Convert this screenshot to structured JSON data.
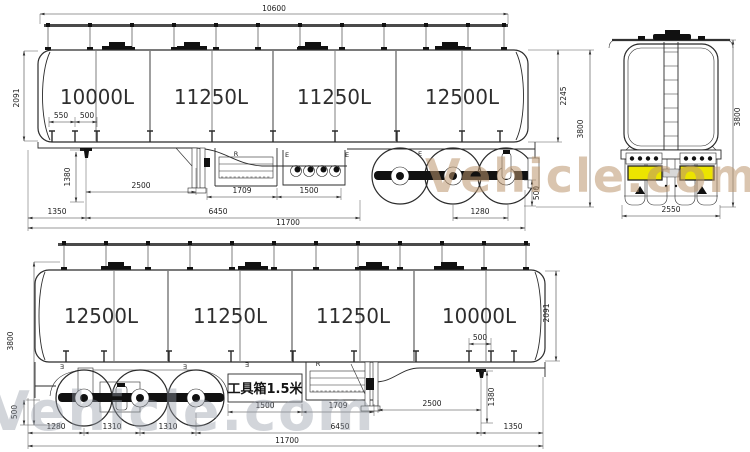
{
  "top_view": {
    "compartments": [
      "10000L",
      "11250L",
      "11250L",
      "12500L"
    ],
    "dims": {
      "overall_length": "10600",
      "front_height": "2091",
      "support_550": "550",
      "support_500": "500",
      "kingpin_height": "1380",
      "kingpin_to_legs": "2500",
      "toolbox_length": "1709",
      "valvebox_length": "1500",
      "front_overhang": "1350",
      "wheelbase": "6450",
      "total_length": "11700",
      "rear_axle_span": "1280",
      "rear_frame_height": "500",
      "tank_rear_height": "2245",
      "overall_height": "3800"
    },
    "mark_e": "E",
    "mark_r": "R"
  },
  "rear_view": {
    "dims": {
      "overall_height": "3800",
      "overall_width": "2550"
    }
  },
  "bottom_view": {
    "compartments": [
      "12500L",
      "11250L",
      "11250L",
      "10000L"
    ],
    "toolbox_label": "工具箱1.5米",
    "dims": {
      "overall_height": "3800",
      "rear_frame_height": "500",
      "rear_axle_span": "1280",
      "axle_spacing_1": "1310",
      "axle_spacing_2": "1310",
      "wheelbase": "6450",
      "front_overhang": "1350",
      "total_length": "11700",
      "valvebox_length": "1500",
      "toolbox_length": "1709",
      "kingpin_to_legs": "2500",
      "kingpin_height": "1380",
      "support_500": "500",
      "front_height": "2091"
    },
    "mark_e": "Ǝ",
    "mark_r": "R"
  },
  "watermark": {
    "top": "Vehicle.com",
    "bottom": "Vehicle.com"
  }
}
